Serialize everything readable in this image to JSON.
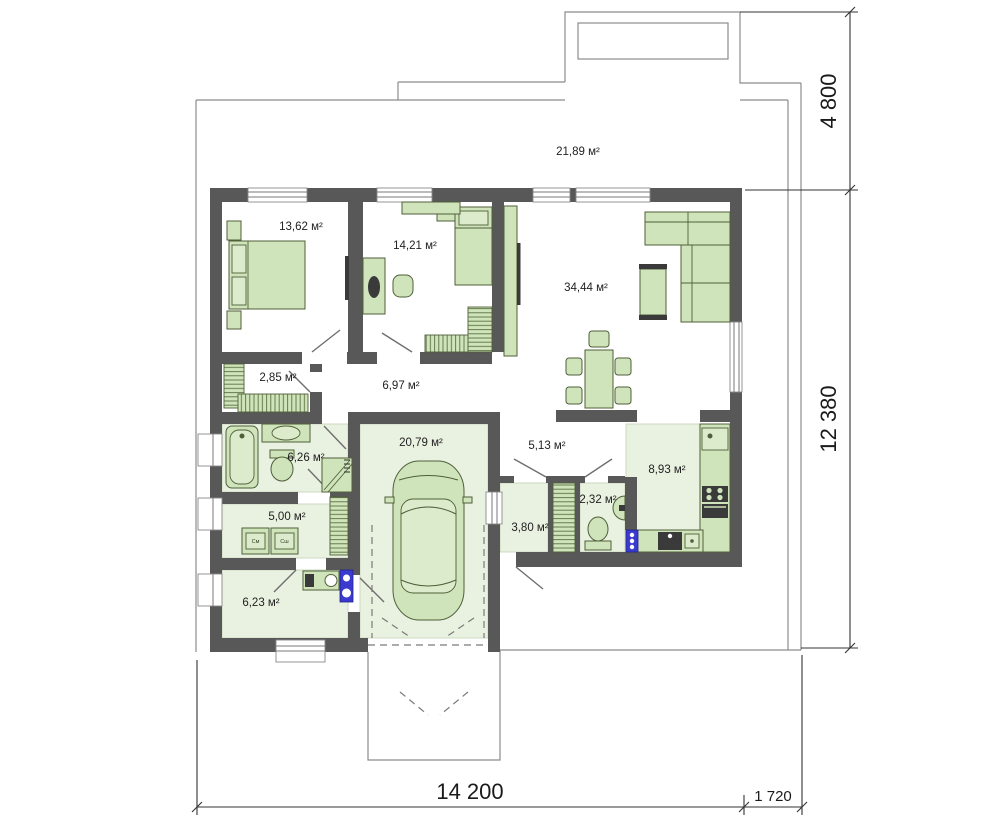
{
  "rooms": {
    "terrace": {
      "area": "21,89 м²"
    },
    "bedroom1": {
      "area": "13,62 м²"
    },
    "bedroom2": {
      "area": "14,21 м²"
    },
    "living": {
      "area": "34,44 м²"
    },
    "wardrobe": {
      "area": "2,85 м²"
    },
    "hallway": {
      "area": "6,97 м²"
    },
    "bathroom": {
      "area": "6,26 м²"
    },
    "laundry": {
      "area": "5,00 м²"
    },
    "utility": {
      "area": "6,23 м²"
    },
    "garage": {
      "area": "20,79 м²"
    },
    "corridor": {
      "area": "5,13 м²"
    },
    "entry": {
      "area": "3,80 м²"
    },
    "wc": {
      "area": "2,32 м²"
    },
    "kitchen": {
      "area": "8,93 м²"
    }
  },
  "appliances": {
    "washer": "См",
    "dryer": "Сш"
  },
  "dimensions": {
    "right_top": "4 800",
    "right_side": "12 380",
    "bottom_width": "14 200",
    "bottom_offset": "1 720"
  },
  "colors": {
    "wall": "#585858",
    "furniture": "#cfe4ba",
    "floor_tint": "#e9f1e1",
    "accent_blue": "#3a3ad0"
  }
}
